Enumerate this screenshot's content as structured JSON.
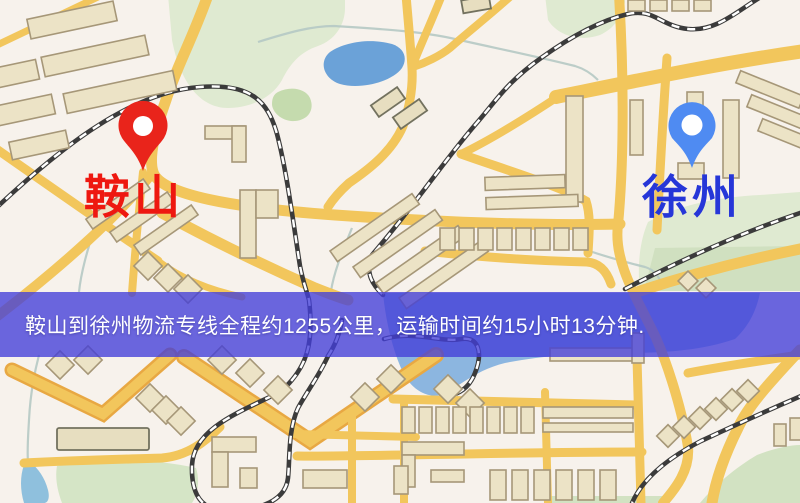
{
  "banner": {
    "text": "鞍山到徐州物流专线全程约1255公里，运输时间约15小时13分钟.",
    "background": "rgba(67,62,216,0.78)",
    "text_color": "#ffffff"
  },
  "markers": {
    "origin": {
      "label": "鞍山",
      "pin_color": "#e9241b",
      "label_color": "#ee1810"
    },
    "destination": {
      "label": "徐州",
      "pin_color": "#4f8bf2",
      "label_color": "#2636d8"
    }
  },
  "route": {
    "origin": "鞍山",
    "destination": "徐州",
    "distance_text": "约1255公里",
    "duration_text": "约15小时13分钟"
  },
  "map": {
    "colors": {
      "background": "#f7f2ec",
      "road": "#f2c65c",
      "road_casing": "#e8a843",
      "railway": "#3b3b3b",
      "building": "#ece3c6",
      "park": "#dfead1",
      "water": "#8cb6e0"
    }
  }
}
